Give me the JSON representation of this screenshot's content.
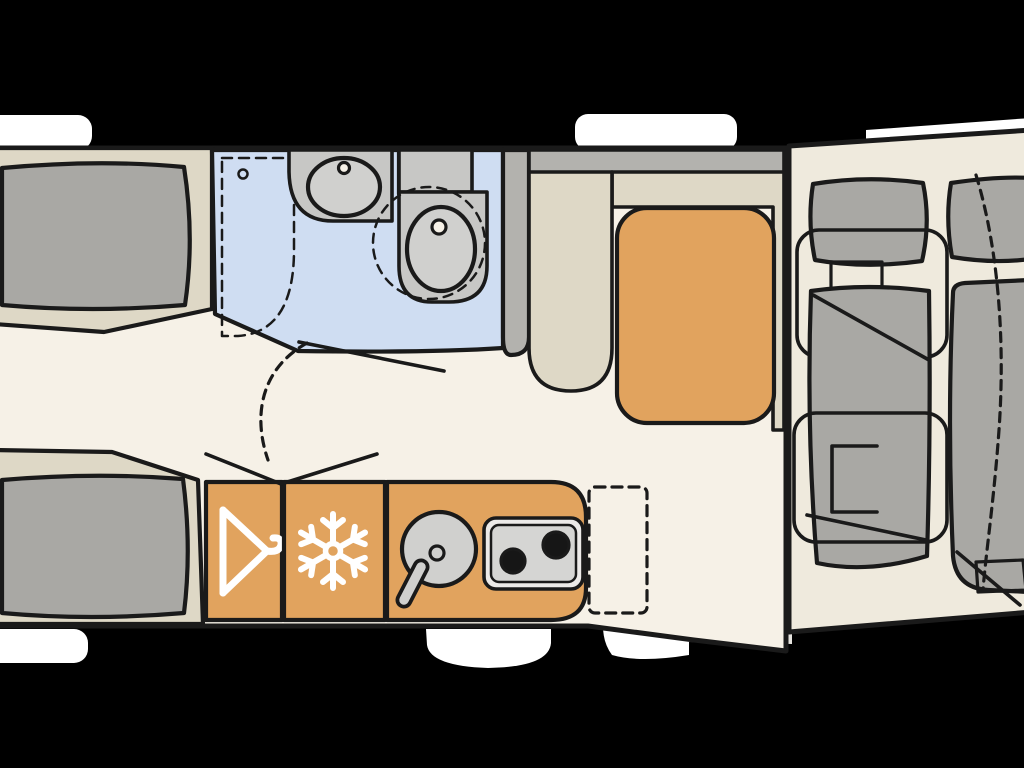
{
  "floorplan": {
    "kind": "caravan-motorhome-layout-top-view",
    "zones": [
      {
        "name": "front-lounge",
        "items": [
          "bench-seat-top",
          "bench-seat-bottom"
        ]
      },
      {
        "name": "washroom",
        "items": [
          "shower",
          "washbasin",
          "swivel-toilet"
        ]
      },
      {
        "name": "dinette",
        "items": [
          "l-shaped-bench",
          "table"
        ]
      },
      {
        "name": "kitchen",
        "items": [
          "wardrobe",
          "refrigerator",
          "round-sink",
          "two-burner-hob"
        ]
      },
      {
        "name": "rear-bedroom",
        "items": [
          "single-bed-left",
          "single-bed-right"
        ]
      }
    ],
    "icons": [
      {
        "name": "hanger-icon",
        "meaning": "wardrobe"
      },
      {
        "name": "snowflake-icon",
        "meaning": "refrigerator"
      }
    ]
  },
  "colors": {
    "background": "#000000",
    "floor": "#f6f1e7",
    "floor_rear": "#efeadd",
    "platform": "#ded8c6",
    "cushion": "#a9a8a4",
    "bathroom": "#cfddf2",
    "fixture": "#c7c7c5",
    "fixture_light": "#d0d0ce",
    "wall": "#b3b2ae",
    "orange": "#e1a35e",
    "stove_outer": "#eceae8",
    "stove_inner": "#d5d5d3",
    "burner": "#161616",
    "window_white": "#ffffff",
    "step": "#e6e4df",
    "outline": "#1a1a1a",
    "icon_white": "#ffffff"
  }
}
